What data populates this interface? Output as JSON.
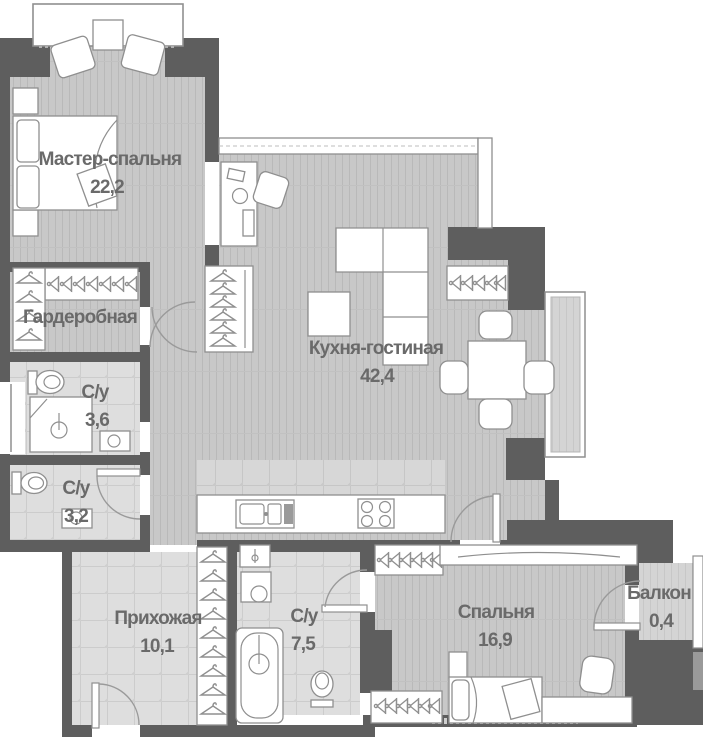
{
  "plan": {
    "title": "apartment-floor-plan",
    "rooms": {
      "master_bedroom": {
        "name": "Мастер-спальня",
        "area": "22,2"
      },
      "wardrobe": {
        "name": "Гардеробная"
      },
      "bathroom_1": {
        "name": "С/у",
        "area": "3,6"
      },
      "bathroom_2": {
        "name": "С/у",
        "area": "3,2"
      },
      "kitchen_living": {
        "name": "Кухня-гостиная",
        "area": "42,4"
      },
      "hallway": {
        "name": "Прихожая",
        "area": "10,1"
      },
      "bathroom_3": {
        "name": "С/у",
        "area": "7,5"
      },
      "bedroom": {
        "name": "Спальня",
        "area": "16,9"
      },
      "balcony": {
        "name": "Балкон",
        "area": "0,4"
      }
    },
    "colors": {
      "wall": "#5e5e5e",
      "floor_plank": "#c8c8c8",
      "floor_plank_line": "#b9b9b9",
      "floor_tile": "#dedede",
      "floor_tile_line": "#cccccc",
      "kitchen_tile": "#d7d7d7",
      "furniture_fill": "#ffffff",
      "furniture_stroke": "#8f8f8f",
      "label_text": "#6a6a6a",
      "background": "#ffffff"
    }
  }
}
